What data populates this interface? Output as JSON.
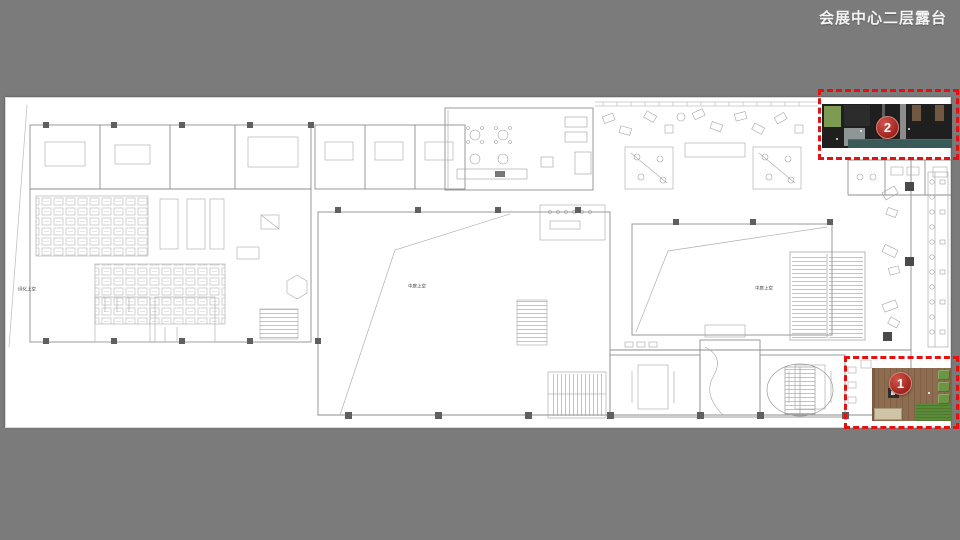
{
  "page": {
    "title": "会展中心二层露台"
  },
  "colors": {
    "background": "#7b7b7b",
    "sheet": "#ffffff",
    "highlight_red": "#e01212",
    "badge_red": "#9e241f",
    "plan_line": "#9a9a9a",
    "deck_wood": "#8d6c50",
    "grass_green": "#5a8a38",
    "terrace_dark": "#1f1f1f"
  },
  "plan": {
    "labels": {
      "atrium_left": "中庭上空",
      "atrium_right": "中庭上空",
      "green_edge": "绿化上空"
    }
  },
  "markers": [
    {
      "number": "1"
    },
    {
      "number": "2"
    }
  ]
}
